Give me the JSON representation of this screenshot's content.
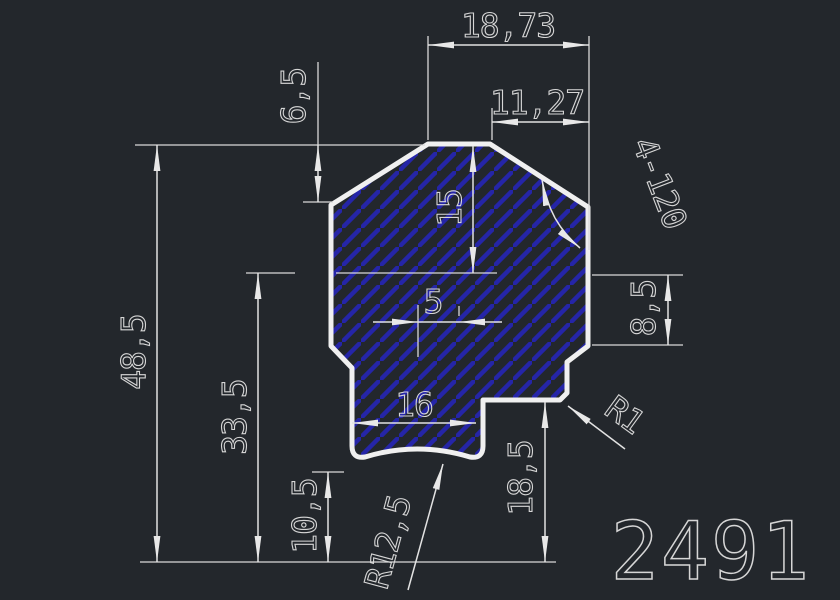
{
  "drawing": {
    "part_number": "2491",
    "dimensions": {
      "dim_18_73": "18,73",
      "dim_11_27": "11,27",
      "dim_6_5": "6,5",
      "dim_15": "15",
      "dim_48_5": "48,5",
      "dim_33_5": "33,5",
      "dim_5": "5",
      "dim_8_5": "8,5",
      "dim_16": "16",
      "dim_18_5": "18,5",
      "dim_10_5": "10,5",
      "radius_1": "R1",
      "radius_12_5": "R12,5",
      "angle_note": "4-120"
    },
    "colors": {
      "background": "#23272c",
      "outline": "#f0f0f0",
      "dimension_lines": "#d9d9d9",
      "hatch_blue": "#2525a8",
      "text": "#d6d6d6"
    }
  }
}
